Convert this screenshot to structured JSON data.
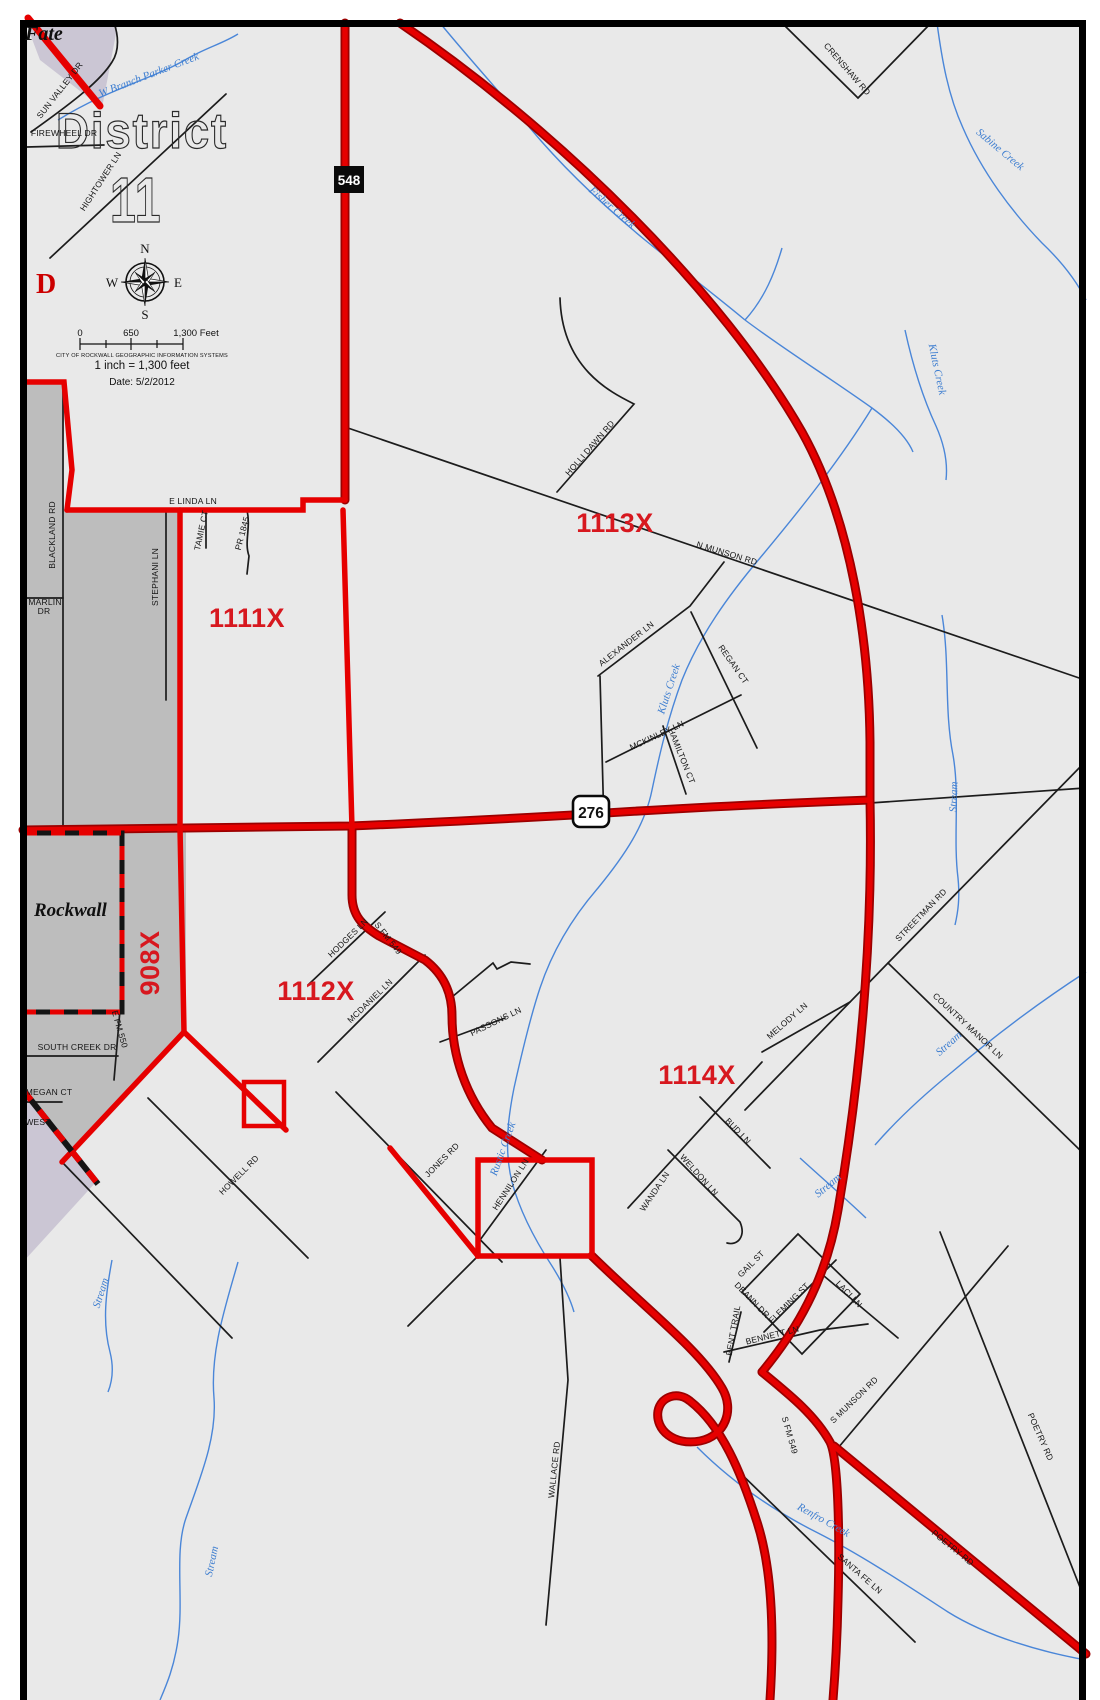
{
  "background_title": {
    "line1": "District",
    "line2": "11"
  },
  "legend": {
    "compass": {
      "n": "N",
      "s": "S",
      "e": "E",
      "w": "W"
    },
    "scale_ticks": [
      "0",
      "650",
      "1,300  Feet"
    ],
    "attribution": "CITY OF ROCKWALL GEOGRAPHIC INFORMATION SYSTEMS",
    "scale_ratio": "1 inch = 1,300 feet",
    "date": "Date: 5/2/2012"
  },
  "shields": {
    "sh548": "548",
    "sh276": "276"
  },
  "place_labels": {
    "fate": "Fate",
    "rockwall": "Rockwall",
    "partial_d": "D"
  },
  "district_labels": [
    {
      "t": "1111X",
      "x": 247,
      "y": 627,
      "r": 0
    },
    {
      "t": "1113X",
      "x": 615,
      "y": 532,
      "r": 0
    },
    {
      "t": "1112X",
      "x": 316,
      "y": 1000,
      "r": 0
    },
    {
      "t": "1114X",
      "x": 697,
      "y": 1084,
      "r": 0
    },
    {
      "t": "908X",
      "x": 159,
      "y": 963,
      "r": -90
    }
  ],
  "street_labels": [
    {
      "t": "SUN VALLEY DR",
      "x": 62,
      "y": 92,
      "r": -52
    },
    {
      "t": "FIREWHEEL DR",
      "x": 64,
      "y": 136,
      "r": 0
    },
    {
      "t": "HIGHTOWER LN",
      "x": 103,
      "y": 183,
      "r": -57
    },
    {
      "t": "E LINDA LN",
      "x": 193,
      "y": 504,
      "r": 0
    },
    {
      "t": "BLACKLAND RD",
      "x": 55,
      "y": 535,
      "r": -90
    },
    {
      "t": "MARLIN",
      "x": 45,
      "y": 605,
      "r": 0
    },
    {
      "t": "DR",
      "x": 44,
      "y": 614,
      "r": 0
    },
    {
      "t": "STEPHANI LN",
      "x": 158,
      "y": 577,
      "r": -90
    },
    {
      "t": "TAMIE CT",
      "x": 204,
      "y": 531,
      "r": -78
    },
    {
      "t": "PR 1845",
      "x": 245,
      "y": 534,
      "r": -75
    },
    {
      "t": "HOLLI DAWN RD",
      "x": 592,
      "y": 450,
      "r": -49
    },
    {
      "t": "N MUNSON RD",
      "x": 726,
      "y": 556,
      "r": 17
    },
    {
      "t": "ALEXANDER LN",
      "x": 628,
      "y": 646,
      "r": -38
    },
    {
      "t": "REGAN CT",
      "x": 731,
      "y": 666,
      "r": 55
    },
    {
      "t": "MCKINLEY LN",
      "x": 658,
      "y": 738,
      "r": -25
    },
    {
      "t": "HAMILTON CT",
      "x": 679,
      "y": 757,
      "r": 68
    },
    {
      "t": "CRENSHAW RD",
      "x": 845,
      "y": 71,
      "r": 49
    },
    {
      "t": "HODGES LN",
      "x": 350,
      "y": 940,
      "r": -44
    },
    {
      "t": "S FM 549",
      "x": 386,
      "y": 940,
      "r": 52
    },
    {
      "t": "MCDANIEL LN",
      "x": 372,
      "y": 1003,
      "r": -44
    },
    {
      "t": "PASSONS LN",
      "x": 497,
      "y": 1024,
      "r": -26
    },
    {
      "t": "HOWELL RD",
      "x": 241,
      "y": 1177,
      "r": -45
    },
    {
      "t": "JONES RD",
      "x": 444,
      "y": 1162,
      "r": -45
    },
    {
      "t": "HENNILON LN",
      "x": 513,
      "y": 1186,
      "r": -57
    },
    {
      "t": "MELODY LN",
      "x": 789,
      "y": 1023,
      "r": -41
    },
    {
      "t": "COUNTRY MANOR LN",
      "x": 966,
      "y": 1028,
      "r": 43
    },
    {
      "t": "STREETMAN RD",
      "x": 923,
      "y": 917,
      "r": -46
    },
    {
      "t": "SOUTH CREEK DR",
      "x": 77,
      "y": 1050,
      "r": 0
    },
    {
      "t": "MEGAN CT",
      "x": 49,
      "y": 1095,
      "r": 0
    },
    {
      "t": "E FM 550",
      "x": 117,
      "y": 1030,
      "r": 74
    },
    {
      "t": "WEST",
      "x": 38,
      "y": 1125,
      "r": 0
    },
    {
      "t": "BUD LN",
      "x": 736,
      "y": 1133,
      "r": 46
    },
    {
      "t": "WELDON LN",
      "x": 697,
      "y": 1177,
      "r": 48
    },
    {
      "t": "WANDA LN",
      "x": 657,
      "y": 1193,
      "r": -56
    },
    {
      "t": "GAIL ST",
      "x": 753,
      "y": 1266,
      "r": -45
    },
    {
      "t": "DEANN DR",
      "x": 750,
      "y": 1302,
      "r": 46
    },
    {
      "t": "FLEMING ST",
      "x": 791,
      "y": 1305,
      "r": -45
    },
    {
      "t": "BENT TRAIL",
      "x": 736,
      "y": 1331,
      "r": -80
    },
    {
      "t": "BENNETT LN",
      "x": 773,
      "y": 1338,
      "r": -14
    },
    {
      "t": "LACI LN",
      "x": 847,
      "y": 1296,
      "r": 46
    },
    {
      "t": "WALLACE RD",
      "x": 557,
      "y": 1470,
      "r": -84
    },
    {
      "t": "SANTA FE LN",
      "x": 858,
      "y": 1576,
      "r": 41
    },
    {
      "t": "S MUNSON RD",
      "x": 856,
      "y": 1402,
      "r": -44
    },
    {
      "t": "POETRY RD",
      "x": 951,
      "y": 1550,
      "r": 39
    },
    {
      "t": "POETRY RD",
      "x": 1038,
      "y": 1438,
      "r": 66
    },
    {
      "t": "S FM 549",
      "x": 787,
      "y": 1436,
      "r": 74
    }
  ],
  "water_labels": [
    {
      "t": "W Branch Parker Creek",
      "x": 150,
      "y": 78,
      "r": -21
    },
    {
      "t": "Sabine Creek",
      "x": 998,
      "y": 152,
      "r": 40
    },
    {
      "t": "Fisher Creek",
      "x": 610,
      "y": 210,
      "r": 41
    },
    {
      "t": "Kluts Creek",
      "x": 934,
      "y": 370,
      "r": 78
    },
    {
      "t": "Kluts Creek",
      "x": 672,
      "y": 690,
      "r": -72
    },
    {
      "t": "Rustic Creek",
      "x": 506,
      "y": 1150,
      "r": -70
    },
    {
      "t": "Renfro Creek",
      "x": 822,
      "y": 1523,
      "r": 29
    },
    {
      "t": "Stream",
      "x": 957,
      "y": 797,
      "r": -88
    },
    {
      "t": "Stream",
      "x": 951,
      "y": 1046,
      "r": -42
    },
    {
      "t": "Stream",
      "x": 830,
      "y": 1188,
      "r": -40
    },
    {
      "t": "Stream",
      "x": 104,
      "y": 1294,
      "r": -72
    },
    {
      "t": "Stream",
      "x": 215,
      "y": 1562,
      "r": -78
    }
  ],
  "colors": {
    "boundary_red": "#e60000",
    "boundary_casing": "#9b0000",
    "district_label_red": "#d7181f",
    "city_gray": "#bdbdbd",
    "neighbor_purple": "#cbc6d4",
    "map_background": "#e9e9e9",
    "water_blue": "#3e7ed0",
    "road_black": "#1c1c1c"
  }
}
